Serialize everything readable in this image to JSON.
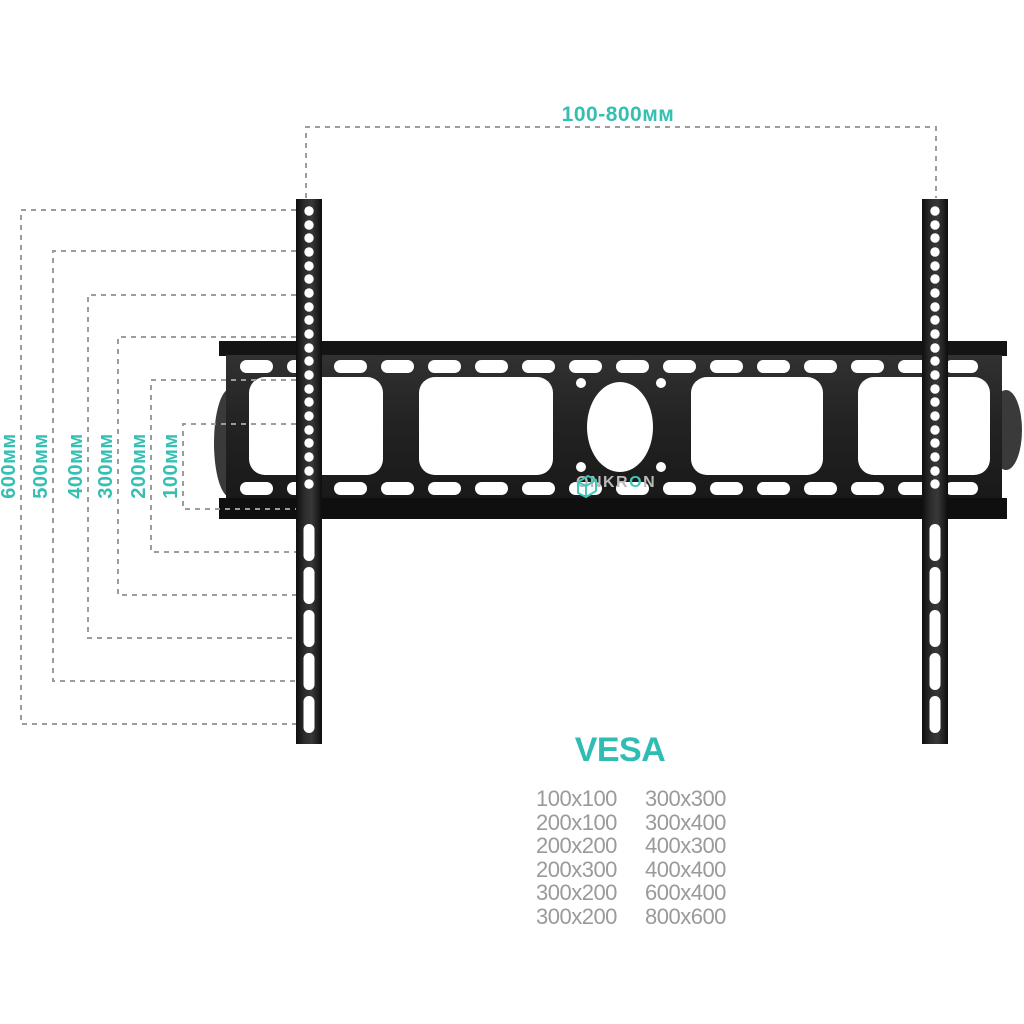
{
  "diagram": {
    "top_dimension_label": "100-800мм",
    "side_dimensions": [
      "600мм",
      "500мм",
      "400мм",
      "300мм",
      "200мм",
      "100мм"
    ],
    "brand": {
      "prefix": "ONKR",
      "accent": "O",
      "suffix": "N"
    },
    "vesa": {
      "title": "VESA",
      "left_column": [
        "100x100",
        "200x100",
        "200x200",
        "200x300",
        "300x200",
        "300x200"
      ],
      "right_column": [
        "300x300",
        "300x400",
        "400x300",
        "400x400",
        "600x400",
        "800x600"
      ]
    },
    "colors": {
      "accent_teal": "#35bfb3",
      "dash_gray": "#9c9c9c",
      "plate_black": "#1f1f1f",
      "table_text_gray": "#9a9a9a"
    }
  }
}
